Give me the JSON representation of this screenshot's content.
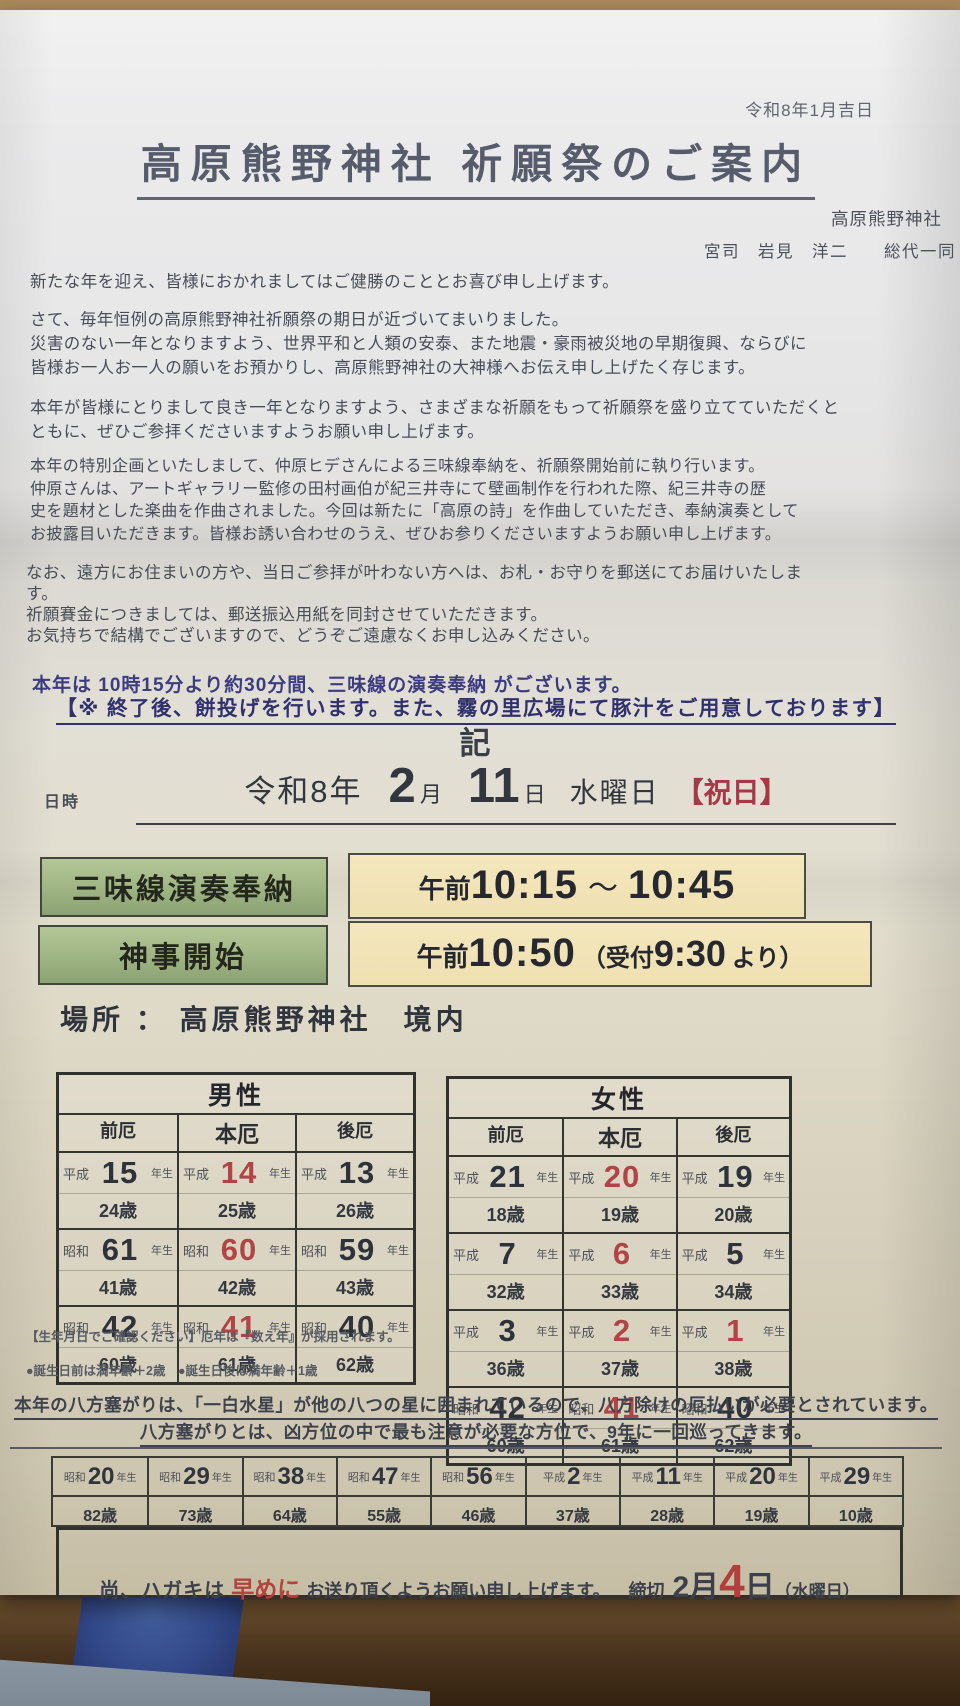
{
  "colors": {
    "notice_purple": "#3c3c80",
    "accent_red": "#b04446",
    "holiday_red": "#a53948",
    "box_green": "#9fb483",
    "box_cream": "#efe0b1",
    "paper": "#e3e2e1"
  },
  "header": {
    "date_note": "令和8年1月吉日",
    "title": "高原熊野神社 祈願祭のご案内",
    "shrine_name": "高原熊野神社",
    "signature": "宮司　岩見　洋二　　総代一同"
  },
  "paragraphs": {
    "p1": "新たな年を迎え、皆様におかれましてはご健勝のこととお喜び申し上げます。",
    "p2": "さて、毎年恒例の高原熊野神社祈願祭の期日が近づいてまいりました。\n災害のない一年となりますよう、世界平和と人類の安泰、また地震・豪雨被災地の早期復興、ならびに\n皆様お一人お一人の願いをお預かりし、高原熊野神社の大神様へお伝え申し上げたく存じます。",
    "p3": "本年が皆様にとりまして良き一年となりますよう、さまざまな祈願をもって祈願祭を盛り立てていただくと\nともに、ぜひご参拝くださいますようお願い申し上げます。",
    "p4": "本年の特別企画といたしまして、仲原ヒデさんによる三味線奉納を、祈願祭開始前に執り行います。\n仲原さんは、アートギャラリー監修の田村画伯が紀三井寺にて壁画制作を行われた際、紀三井寺の歴\n史を題材とした楽曲を作曲されました。今回は新たに「高原の詩」を作曲していただき、奉納演奏として\nお披露目いただきます。皆様お誘い合わせのうえ、ぜひお参りくださいますようお願い申し上げます。",
    "p5": "なお、遠方にお住まいの方や、当日ご参拝が叶わない方へは、お札・お守りを郵送にてお届けいたしま\nす。\n祈願賽金につきましては、郵送振込用紙を同封させていただきます。\nお気持ちで結構でございますので、どうぞご遠慮なくお申し込みください。"
  },
  "notice": {
    "line1": "本年は 10時15分より約30分間、三味線の演奏奉納 がございます。",
    "line2": "【※ 終了後、餅投げを行います。また、霧の里広場にて豚汁をご用意しております】"
  },
  "record_mark": "記",
  "datetime": {
    "label": "日時",
    "era_year": "令和8年",
    "month_num": "2",
    "month_unit": "月",
    "day_num": "11",
    "day_unit": "日",
    "weekday": "水曜日",
    "holiday": "【祝日】"
  },
  "schedule": {
    "row1": {
      "label": "三味線演奏奉納",
      "prefix": "午前",
      "start": "10:15",
      "sep": "～",
      "end": "10:45"
    },
    "row2": {
      "label": "神事開始",
      "prefix": "午前",
      "start": "10:50",
      "paren_open": "（受付 ",
      "paren_time": "9:30",
      "paren_close": "より）"
    }
  },
  "place": {
    "label": "場所",
    "sep": "：",
    "value": "高原熊野神社　境内"
  },
  "yaku_tables": [
    {
      "title": "男性",
      "columns": [
        "前厄",
        "本厄",
        "後厄"
      ],
      "year_suffix": "年生",
      "rows": [
        [
          {
            "era": "平成",
            "year": "15",
            "age": "24歳"
          },
          {
            "era": "平成",
            "year": "14",
            "age": "25歳",
            "red": true
          },
          {
            "era": "平成",
            "year": "13",
            "age": "26歳"
          }
        ],
        [
          {
            "era": "昭和",
            "year": "61",
            "age": "41歳"
          },
          {
            "era": "昭和",
            "year": "60",
            "age": "42歳",
            "red": true
          },
          {
            "era": "昭和",
            "year": "59",
            "age": "43歳"
          }
        ],
        [
          {
            "era": "昭和",
            "year": "42",
            "age": "60歳"
          },
          {
            "era": "昭和",
            "year": "41",
            "age": "61歳",
            "red": true
          },
          {
            "era": "昭和",
            "year": "40",
            "age": "62歳"
          }
        ]
      ]
    },
    {
      "title": "女性",
      "columns": [
        "前厄",
        "本厄",
        "後厄"
      ],
      "year_suffix": "年生",
      "rows": [
        [
          {
            "era": "平成",
            "year": "21",
            "age": "18歳"
          },
          {
            "era": "平成",
            "year": "20",
            "age": "19歳",
            "red": true
          },
          {
            "era": "平成",
            "year": "19",
            "age": "20歳"
          }
        ],
        [
          {
            "era": "平成",
            "year": "7",
            "age": "32歳"
          },
          {
            "era": "平成",
            "year": "6",
            "age": "33歳",
            "red": true
          },
          {
            "era": "平成",
            "year": "5",
            "age": "34歳"
          }
        ],
        [
          {
            "era": "平成",
            "year": "3",
            "age": "36歳"
          },
          {
            "era": "平成",
            "year": "2",
            "age": "37歳",
            "red": true
          },
          {
            "era": "平成",
            "year": "1",
            "age": "38歳",
            "red": true
          }
        ],
        [
          {
            "era": "昭和",
            "year": "42",
            "age": "60歳"
          },
          {
            "era": "昭和",
            "year": "41",
            "age": "61歳",
            "red": true
          },
          {
            "era": "昭和",
            "year": "40",
            "age": "62歳"
          }
        ]
      ]
    }
  ],
  "yaku_note": "【生年月日でご確認ください】厄年は『数え年』が採用されます。\n●誕生日前は満年齢＋2歳　●誕生日後は満年齢＋1歳",
  "happo": {
    "line1": "本年の八方塞がりは、「一白水星」が他の八つの星に囲まれているので、八方除けの厄払いが必要とされています。",
    "line2": "八方塞がりとは、凶方位の中で最も注意が必要な方位で、9年に一回巡ってきます。"
  },
  "happo_table": {
    "year_suffix": "年生",
    "cells": [
      {
        "era": "昭和",
        "year": "20",
        "age": "82歳"
      },
      {
        "era": "昭和",
        "year": "29",
        "age": "73歳"
      },
      {
        "era": "昭和",
        "year": "38",
        "age": "64歳"
      },
      {
        "era": "昭和",
        "year": "47",
        "age": "55歳"
      },
      {
        "era": "昭和",
        "year": "56",
        "age": "46歳"
      },
      {
        "era": "平成",
        "year": "2",
        "age": "37歳"
      },
      {
        "era": "平成",
        "year": "11",
        "age": "28歳"
      },
      {
        "era": "平成",
        "year": "20",
        "age": "19歳"
      },
      {
        "era": "平成",
        "year": "29",
        "age": "10歳"
      }
    ]
  },
  "footer": {
    "pre": "尚、ハガキは",
    "emph": "早めに",
    "post": "お送り頂くようお願い申し上げます。",
    "deadline_label": "締切",
    "deadline_month": "2月",
    "deadline_day": "4",
    "deadline_day_unit": "日",
    "deadline_weekday": "（水曜日）"
  }
}
